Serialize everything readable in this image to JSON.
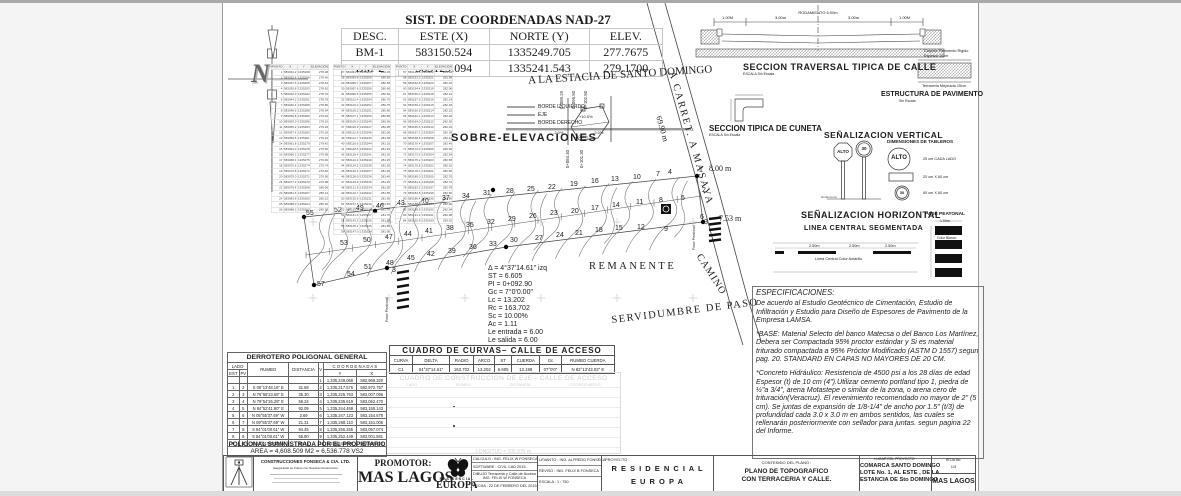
{
  "coord_system": {
    "title": "SIST. DE COORDENADAS NAD-27",
    "headers": [
      "DESC.",
      "ESTE (X)",
      "NORTE (Y)",
      "ELEV."
    ],
    "rows": [
      [
        "BM-1",
        "583150.524",
        "1335249.705",
        "277.7675"
      ],
      [
        "BM-2",
        "583129.094",
        "1335241.543",
        "279.1700"
      ]
    ]
  },
  "station_tables": {
    "headers": [
      "PUNTO",
      "X",
      "Y",
      "ELEVACION"
    ],
    "tables": [
      {
        "rows": [
          "1 583033.2 1335298 278.38",
          "2 583035.4 1335296 278.46",
          "3 583037.6 1335295 278.54",
          "4 583039.8 1335293 278.62",
          "5 583042.0 1335292 278.70",
          "6 583044.2 1335291 278.78",
          "7 583046.4 1335289 278.86",
          "8 583048.6 1335288 278.94",
          "9 583050.8 1335286 279.02",
          "10 583053.0 1335285 279.10",
          "11 583055.2 1335284 279.18",
          "12 583057.4 1335282 279.26",
          "13 583059.6 1335281 279.34",
          "14 583061.8 1335279 279.42",
          "15 583064.0 1335278 279.50",
          "16 583066.2 1335277 279.58",
          "17 583068.4 1335275 279.66",
          "18 583070.6 1335274 279.74",
          "19 583072.8 1335272 279.82",
          "20 583075.0 1335271 279.90",
          "21 583077.2 1335270 279.98",
          "22 583079.4 1335268 280.06",
          "23 583081.6 1335267 280.14",
          "24 583083.8 1335265 280.22",
          "25 583086.0 1335264 280.30",
          "26 583088.2 1335263 280.38"
        ]
      },
      {
        "rows": [
          "27 583091.9 1335260 280.45",
          "28 583093.8 1335259 280.50",
          "29 583095.7 1335257 280.55",
          "30 583097.6 1335256 280.60",
          "31 583099.5 1335255 280.65",
          "32 583101.4 1335254 280.70",
          "33 583103.3 1335252 280.75",
          "34 583105.2 1335251 280.80",
          "35 583107.1 1335250 280.85",
          "36 583109.0 1335249 280.90",
          "37 583110.9 1335247 280.95",
          "38 583112.8 1335246 281.00",
          "39 583114.7 1335245 281.05",
          "40 583116.6 1335244 281.10",
          "41 583118.5 1335242 281.15",
          "42 583120.4 1335241 281.20",
          "43 583122.3 1335240 281.25",
          "44 583124.2 1335239 281.30",
          "45 583126.1 1335237 281.35",
          "46 583128.0 1335236 281.40",
          "47 583129.9 1335235 281.45",
          "48 583131.8 1335234 281.50",
          "49 583133.7 1335232 281.55",
          "50 583135.6 1335231 281.60",
          "51 583137.5 1335230 281.65",
          "52 583139.4 1335229 281.70",
          "53 583141.3 1335227 281.75",
          "54 583143.2 1335226 281.80",
          "55 583145.1 1335225 281.85",
          "56 583147.0 1335224 281.90"
        ]
      },
      {
        "rows": [
          "57 583149.6 1335222 281.94",
          "58 583151.2 1335221 281.98",
          "59 583152.8 1335220 282.02",
          "60 583154.4 1335219 282.06",
          "61 583156.0 1335218 282.10",
          "62 583157.6 1335216 282.14",
          "63 583159.2 1335215 282.18",
          "64 583160.8 1335214 282.22",
          "65 583162.4 1335213 282.26",
          "66 583164.0 1335212 282.30",
          "67 583165.6 1335210 282.34",
          "68 583167.2 1335209 282.38",
          "69 583168.8 1335208 282.42",
          "70 583170.4 1335207 282.46",
          "71 583172.0 1335206 282.50",
          "72 583173.6 1335204 282.54",
          "73 583175.2 1335203 282.58",
          "74 583176.8 1335202 282.62",
          "75 583178.4 1335201 282.66",
          "76 583180.0 1335200 282.70",
          "77 583181.6 1335198 282.74",
          "78 583183.2 1335197 282.78",
          "79 583184.8 1335196 282.82",
          "80 583186.4 1335195 282.86",
          "81 583188.0 1335194 282.90",
          "82 583189.6 1335192 282.94",
          "83 583191.2 1335191 282.98",
          "84 583192.8 1335190 283.02"
        ]
      }
    ]
  },
  "plan": {
    "labels": {
      "destination": "A LA ESTACIA DE SANTO DOMINGO",
      "road": "A CARRET. A MASAYA",
      "road_length": "69.90 m",
      "width1": "8.00 m",
      "width2": "7.53 m",
      "camino": "CAMINO",
      "remanente": "REMANENTE",
      "servidumbre": "SERVIDUMBRE DE PASO",
      "pase_peatonal": "Pase Peatonal"
    },
    "points": [
      [
        55,
        83,
        212
      ],
      [
        52,
        111,
        209
      ],
      [
        49,
        133,
        207
      ],
      [
        46,
        153,
        205
      ],
      [
        43,
        174,
        202
      ],
      [
        40,
        198,
        200
      ],
      [
        37,
        219,
        197
      ],
      [
        34,
        239,
        195
      ],
      [
        31,
        260,
        192
      ],
      [
        28,
        283,
        190
      ],
      [
        25,
        304,
        188
      ],
      [
        22,
        325,
        186
      ],
      [
        19,
        347,
        183
      ],
      [
        16,
        368,
        180
      ],
      [
        13,
        388,
        178
      ],
      [
        10,
        410,
        176
      ],
      [
        7,
        433,
        173
      ],
      [
        4,
        445,
        171
      ],
      [
        1,
        476,
        169
      ],
      [
        53,
        117,
        242
      ],
      [
        50,
        140,
        239
      ],
      [
        47,
        162,
        236
      ],
      [
        44,
        181,
        233
      ],
      [
        41,
        202,
        230
      ],
      [
        38,
        223,
        227
      ],
      [
        35,
        243,
        224
      ],
      [
        32,
        264,
        221
      ],
      [
        29,
        285,
        218
      ],
      [
        26,
        306,
        215
      ],
      [
        23,
        327,
        212
      ],
      [
        20,
        348,
        210
      ],
      [
        17,
        368,
        207
      ],
      [
        14,
        389,
        204
      ],
      [
        11,
        413,
        201
      ],
      [
        8,
        436,
        199
      ],
      [
        5,
        458,
        197
      ],
      [
        2,
        479,
        189
      ],
      [
        57,
        94,
        283
      ],
      [
        54,
        124,
        273
      ],
      [
        51,
        141,
        266
      ],
      [
        48,
        163,
        262
      ],
      [
        45,
        184,
        257
      ],
      [
        42,
        204,
        253
      ],
      [
        39,
        225,
        250
      ],
      [
        36,
        246,
        246
      ],
      [
        33,
        266,
        243
      ],
      [
        30,
        287,
        239
      ],
      [
        27,
        312,
        237
      ],
      [
        24,
        333,
        234
      ],
      [
        21,
        352,
        232
      ],
      [
        18,
        372,
        229
      ],
      [
        15,
        392,
        227
      ],
      [
        12,
        414,
        226
      ],
      [
        9,
        441,
        228
      ],
      [
        6,
        477,
        216
      ],
      [
        3,
        481,
        221
      ],
      [
        3,
        169,
        269
      ]
    ],
    "dots": [
      [
        81,
        214
      ],
      [
        152,
        208
      ],
      [
        91,
        282
      ],
      [
        164,
        265
      ],
      [
        270,
        187
      ],
      [
        283,
        244
      ],
      [
        474,
        173
      ],
      [
        480,
        219
      ]
    ]
  },
  "sobre_elevaciones": {
    "title": "SOBRE-ELEVACIONES",
    "legend": [
      "BORDE  IZQUIERDO",
      "EJE",
      "BORDE  DERECHO"
    ],
    "stations_top": [
      "0+089.29",
      "0+096.50",
      "0+102.50"
    ],
    "stations_bottom": [
      "0+084.40",
      "0+101.30"
    ],
    "pct_plus10": "+10.0%",
    "pct_minus10": "-10.0%",
    "pct_minus2a": "-2.0%",
    "pct_minus2b": "-2.0%"
  },
  "curve_note": {
    "lines": [
      "Δ = 4°37'14.61\"  izq",
      "ST = 6.605",
      "PI = 0+092.90",
      "Gc = 7°0'0.00\"",
      "Lc = 13.202",
      "Rc = 163.702",
      "Sc = 10.00%",
      "Ac = 1.11",
      "Le  entrada = 6.00",
      "Le  salida = 6.00"
    ]
  },
  "curvas_table": {
    "title": "CUADRO  DE  CURVAS–  CALLE  DE  ACCESO",
    "headers": [
      "CURVA",
      "DELTA",
      "RADIO",
      "ARCO",
      "ST",
      "CUERDA",
      "Gc",
      "RUMBO CUERDA"
    ],
    "rows": [
      [
        "C1",
        "04°37'14.61\"",
        "163.702",
        "13.202",
        "6.605",
        "13.198",
        "07°0'0\"",
        "N 82°13'43.02\" E"
      ]
    ]
  },
  "construccion_table": {
    "title": "CUADRO DE CONSTRUCCION DE EJE - CALLE DE ACCESO",
    "headers": [
      "LADO",
      "RUMBO",
      "DISTANCIA",
      "COORDENADAS"
    ],
    "footer": "LONGITUD  =  105.975 m"
  },
  "derrotero": {
    "title": "DERROTERO POLIGONAL GENERAL",
    "h_lado": "LADO",
    "h_est": "EST",
    "h_pv": "PV",
    "h_rumbo": "RUMBO",
    "h_dist": "DISTANCIA",
    "h_v": "V",
    "h_coord": "C O O R D E N A D A S",
    "h_y": "Y",
    "h_x": "X",
    "rows": [
      [
        "",
        "",
        "",
        "",
        "1",
        "1,335,249.068",
        "582,969.320"
      ],
      [
        "1",
        "2",
        "S 06°13'48.16\" E",
        "31.68",
        "2",
        "1,335,217.576",
        "582,972.757"
      ],
      [
        "2",
        "3",
        "N 76°58'23.68\" E",
        "35.30",
        "3",
        "1,335,225.763",
        "583,007.096"
      ],
      [
        "3",
        "4",
        "N 79°54'26.28\" E",
        "56.24",
        "4",
        "1,335,235.619",
        "583,062.470"
      ],
      [
        "4",
        "5",
        "N 84°52'41.90\" E",
        "92.09",
        "5",
        "1,335,244.469",
        "583,155.143"
      ],
      [
        "5",
        "6",
        "N 05°55'37.69\" W",
        "2.69",
        "6",
        "1,335,247.123",
        "583,154.678"
      ],
      [
        "6",
        "7",
        "N 09°55'37.69\" W",
        "21.31",
        "7",
        "1,335,268.110",
        "583,151.005"
      ],
      [
        "7",
        "8",
        "S 84°01'00.61\" W",
        "94.45",
        "8",
        "1,335,256.265",
        "583,057.074"
      ],
      [
        "8",
        "9",
        "S 84°01'00.61\" W",
        "55.80",
        "9",
        "1,335,252.449",
        "583,001.581"
      ],
      [
        "9",
        "1",
        "S 84°01'00.61\" W",
        "32.44",
        "1",
        "1,335,249.068",
        "582,969.320"
      ]
    ],
    "area": "AREA = 4,608.509 M2 =  6,536.778 VS2",
    "note": "POLIGONAL SUMINISTRADA POR EL PROPIETARIO"
  },
  "sections": {
    "calle": {
      "title": "SECCION TRAVERSAL TIPICA DE CALLE",
      "subtitle": "ESCALA   Sin Escala",
      "rodamiento": "RODAMIENTO 6.00m",
      "d1": "1.00M",
      "d2": "3.00m",
      "d3": "3.00m",
      "d4": "1.00M"
    },
    "pavimento": {
      "title": "ESTRUCTURA DE PAVIMENTO",
      "subtitle": "Sin Escala",
      "l1a": "Carpeta Pavimento Rigido",
      "l1b": "Espesor 10cm",
      "l2": "Terraceria Mejorada 15cm"
    },
    "cuneta": {
      "title": "SECCION TIPICA DE CUNETA",
      "subtitle": "ESCALA  Sin Escala"
    },
    "senal_vertical": {
      "title": "SEÑALIZACION VERTICAL",
      "subtitle": "DIMENSIONES DE TABLEROS",
      "alto": "ALTO",
      "speed": "30",
      "dim1": "25 cm CADA LADO",
      "dim2": "20 cm X 60 cm",
      "dim3": "60 cm X 60 cm",
      "ref": "Rodamiento"
    },
    "senal_horizontal": {
      "title": "SEÑALIZACION HORIZONTAL",
      "sub1": "LINEA CENTRAL SEGMENTADA",
      "dash_dim": "2.50m",
      "center_note": "Linea Central Color Amarillo",
      "pase_title": "PASE PEATONAL",
      "pase_dim": "1.00m",
      "color_note": "Color Blanco"
    }
  },
  "specs": {
    "title": "ESPECIFICACIONES:",
    "p1": "De acuerdo al Estudio Geotécnico de Cimentación, Estudio de Infiltración y Estudio para Diseño de Espesores de Pavimento de la Empresa LAMSA.",
    "p2": "*BASE: Material Selecto del banco Matecsa o del Banco Los Martínez, Debera ser Compactada 95% proctor estándar y Si es material triturado compactada a 95% Próctor Modificado (ASTM D 1557) segun pag. 20. STANDARD EN CAPAS NO MAYORES DE 20 CM.",
    "p3": "*Concreto Hidráulico: Resistencia de 4500 psi a los 28 días de edad Espesor (t) de 10 cm (4\").Utilizar cemento portland tipo 1, piedra de ½\"a 3/4\", arena Motastepe o similar de la zona, o arena cero de trituración(Veracruz). El revenimiento recomendado no mayor de 2\" (5 cm). Se juntas de expansión de 1/8-1/4\" de ancho por 1.5\" (t/3) de profundidad cada 3.0 x 3.0 m en ambos sentidos, las cuales se rellenarán posteriormente con sellador para juntas. segun pagina 22 del Informe."
  },
  "titleblock": {
    "company": "CONSTRUCCIONES FONSECA & CIA. LTD.",
    "tagline": "Asegurando su Futuro con Nuestra Construccion",
    "promotor_label": "PROMOTOR:",
    "promotor": "MAS LAGOS",
    "residencial": "RESIDENCIAL",
    "europa": "EUROPA",
    "calculo": "CALCULO :   ING. FELIX W FONSECA",
    "software": "SOFTWARE :   CIVIL CAD  2015.",
    "dibujo1": "DIBUJO  Terraceria y Calle de Acceso",
    "dibujo2": "ING. FELIX W FONSECA",
    "fecha": "FECHA : 22 DE FEBRERO DEL 2015",
    "levanto": "LEVANTO :  ING. ALFREDO FONSECA",
    "reviso": "REVISO :  ING. FELIX B FONSECA",
    "escala": "ESCALA :   1 : 750",
    "proyecto_label": "PROYECTO :",
    "proyecto1": "R E S I D E N C I A L",
    "proyecto2": "E U R O P A",
    "contenido_label": "CONTENIDO  DEL  PLANO :",
    "contenido1": "PLANO DE TOPOGRAFICO",
    "contenido2": "CON TERRACERIA Y CALLE.",
    "lugar_label": "LUGAR  DEL  PROYECTO :",
    "lugar1": "COMARCA SANTO DOMINGO",
    "lugar2": "LOTE No. 1, AL ESTE , DE LA",
    "lugar3": "ESTANCIA DE Sto DOMINGO",
    "hoja_label": "HOJA  No.",
    "hoja": "1/3",
    "maslagos_small": "MAS LAGOS"
  }
}
